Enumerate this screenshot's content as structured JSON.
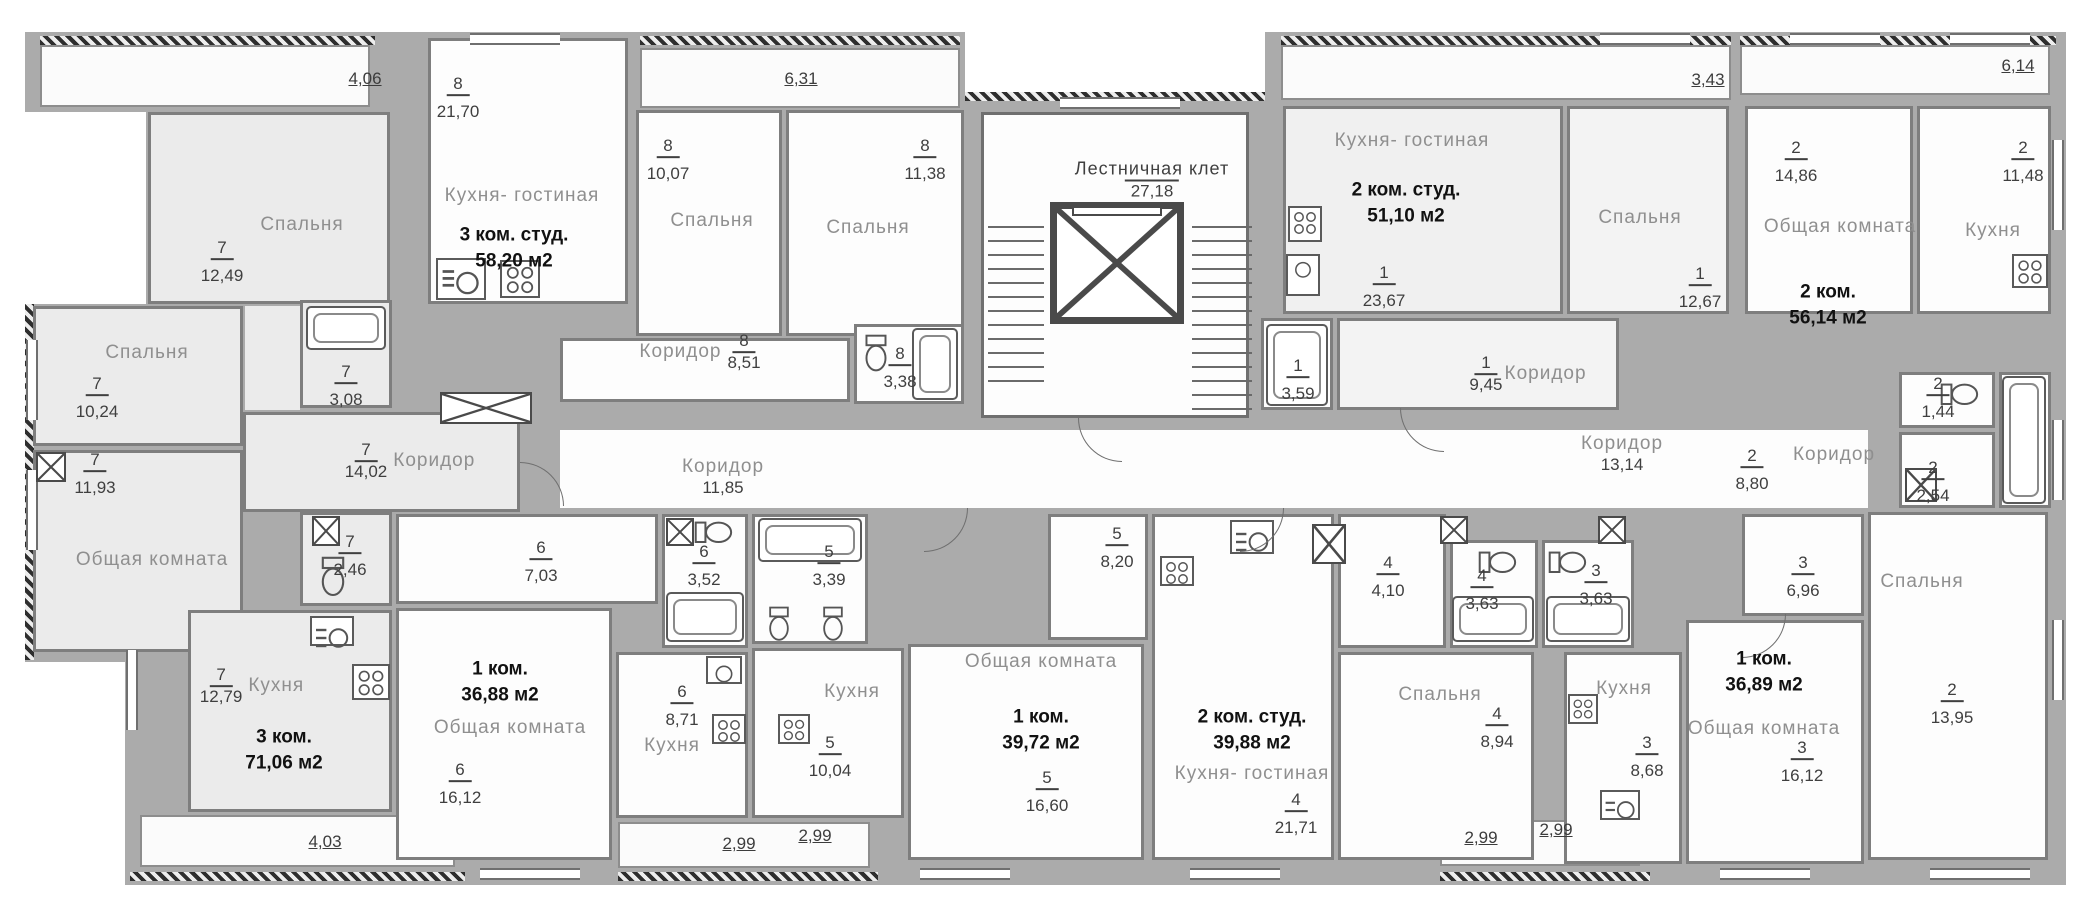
{
  "floorplan": {
    "stairwell": {
      "label": "Лестничная клет",
      "area": "27,18"
    },
    "shared_corridors": {
      "c1": {
        "label": "Коридор",
        "area": "11,85"
      },
      "c2": {
        "label": "Коридор",
        "area": "13,14"
      }
    },
    "dims_top": [
      "4,06",
      "6,31",
      "3,43",
      "6,14"
    ],
    "dims_bottom": [
      "4,03",
      "2,99",
      "2,99",
      "2,99",
      "2,99"
    ],
    "apartments": {
      "apt1": {
        "num": "1",
        "title1": "2 ком. студ.",
        "title2": "51,10 м2",
        "rooms": {
          "kitchen_living": {
            "name": "Кухня- гостиная",
            "area": "23,67"
          },
          "bedroom": {
            "name": "Спальня",
            "area": "12,67"
          },
          "corridor": {
            "name": "Коридор",
            "area": "9,45"
          },
          "bath": {
            "area": "3,59"
          }
        }
      },
      "apt2": {
        "num": "2",
        "title1": "2 ком.",
        "title2": "56,14 м2",
        "rooms": {
          "common": {
            "name": "Общая комната",
            "area": "14,86"
          },
          "kitchen": {
            "name": "Кухня",
            "area": "11,48"
          },
          "corridor": {
            "name": "Коридор",
            "area": "8,80"
          },
          "bath": {
            "area": "1,44"
          },
          "wc": {
            "area": "2,54"
          },
          "bedroom": {
            "name": "Спальня",
            "area": "13,95"
          }
        }
      },
      "apt3": {
        "num": "3",
        "title1": "1 ком.",
        "title2": "36,89 м2",
        "rooms": {
          "bath": {
            "area": "3,63"
          },
          "hall": {
            "area": "6,96"
          },
          "kitchen": {
            "name": "Кухня",
            "area": "8,68"
          },
          "common": {
            "name": "Общая комната",
            "area": "16,12"
          }
        }
      },
      "apt4": {
        "num": "4",
        "title1": "2 ком. студ.",
        "title2": "39,88 м2",
        "rooms": {
          "hall": {
            "area": "4,10"
          },
          "bath": {
            "area": "3,63"
          },
          "kitchen_living": {
            "name": "Кухня- гостиная",
            "area": "21,71"
          },
          "bedroom": {
            "name": "Спальня",
            "area": "8,94"
          }
        }
      },
      "apt5": {
        "num": "5",
        "title1": "1 ком.",
        "title2": "39,72 м2",
        "rooms": {
          "bath": {
            "area": "3,39"
          },
          "hall": {
            "area": "8,20"
          },
          "kitchen": {
            "name": "Кухня",
            "area": "10,04"
          },
          "common": {
            "name": "Общая комната",
            "area": "16,60"
          }
        }
      },
      "apt6": {
        "num": "6",
        "title1": "1 ком.",
        "title2": "36,88 м2",
        "rooms": {
          "hall": {
            "area": "7,03"
          },
          "bath": {
            "area": "3,52"
          },
          "kitchen": {
            "name": "Кухня",
            "area": "8,71"
          },
          "common": {
            "name": "Общая комната",
            "area": "16,12"
          }
        }
      },
      "apt7": {
        "num": "7",
        "title1": "3 ком.",
        "title2": "71,06 м2",
        "rooms": {
          "bed_top": {
            "name": "Спальня",
            "area": "12,49"
          },
          "bed_left": {
            "name": "Спальня",
            "area": "10,24"
          },
          "common": {
            "name": "Общая комната",
            "area": "11,93"
          },
          "bath": {
            "area": "3,08"
          },
          "corridor": {
            "name": "Коридор",
            "area": "14,02"
          },
          "wc": {
            "area": "2,46"
          },
          "kitchen": {
            "name": "Кухня",
            "area": "12,79"
          }
        }
      },
      "apt8": {
        "num": "8",
        "title1": "3 ком. студ.",
        "title2": "58,20 м2",
        "rooms": {
          "kitchen_living": {
            "name": "Кухня- гостиная",
            "area": "21,70"
          },
          "bed1": {
            "name": "Спальня",
            "area": "10,07"
          },
          "bed2": {
            "name": "Спальня",
            "area": "11,38"
          },
          "corridor": {
            "name": "Коридор",
            "area": "8,51"
          },
          "bath": {
            "area": "3,38"
          }
        }
      }
    }
  }
}
